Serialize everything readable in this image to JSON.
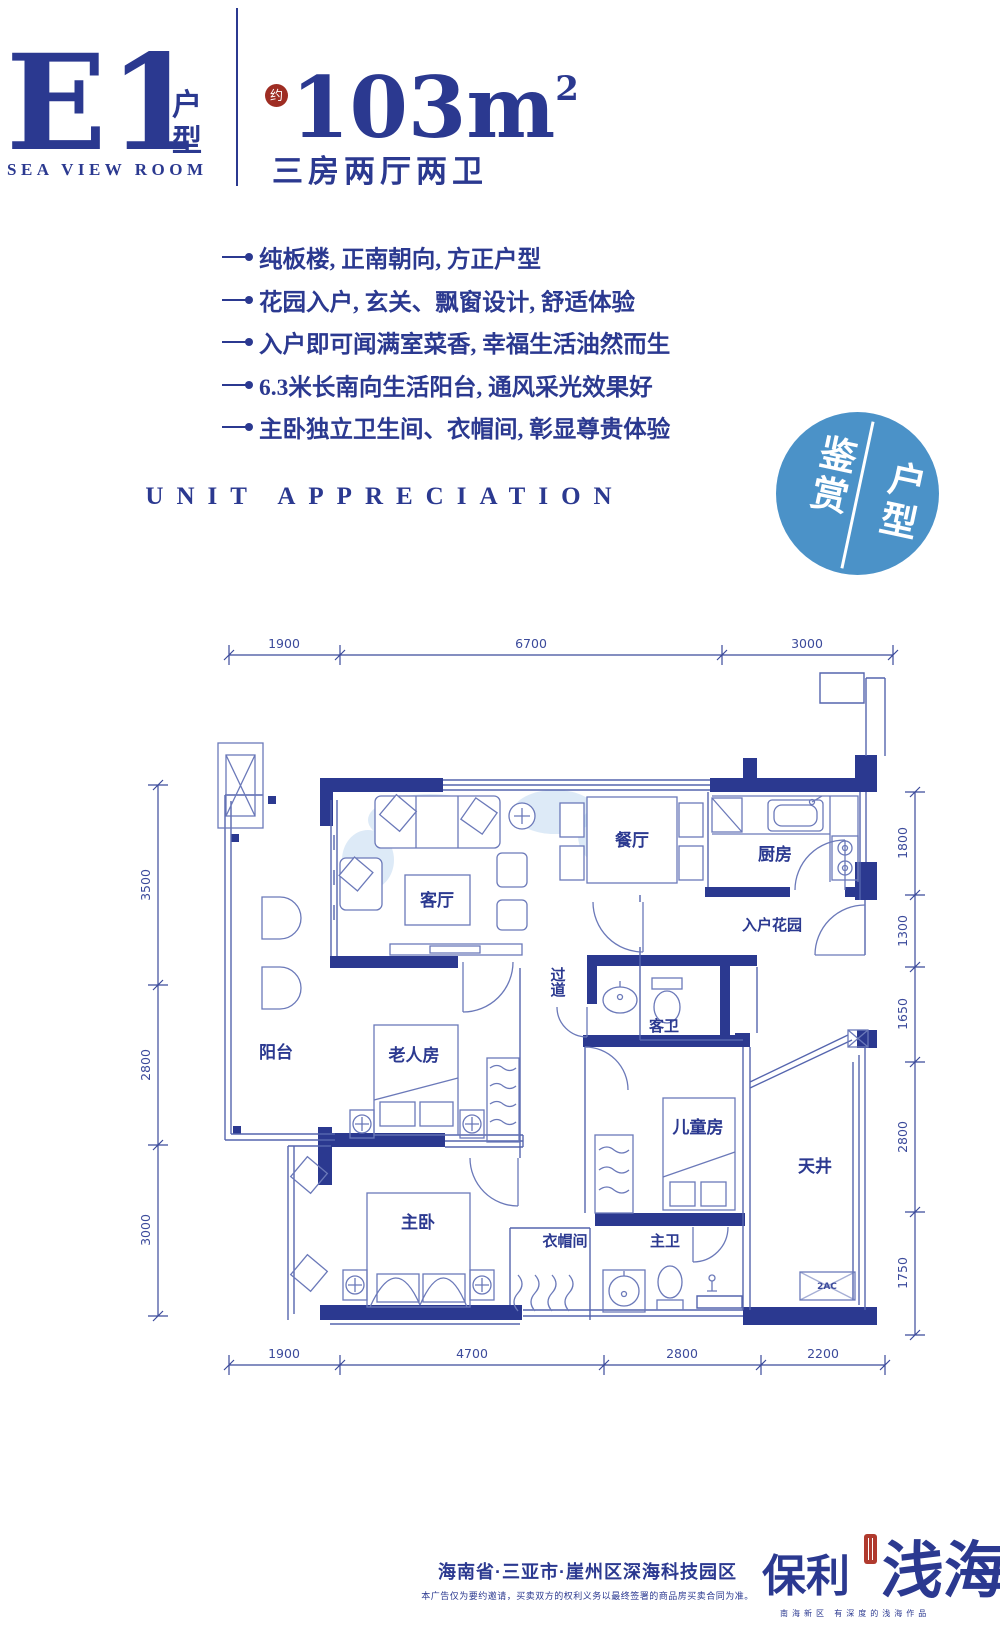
{
  "header": {
    "unit_code": "E1",
    "unit_type_label": "户型",
    "subtitle_en": "SEA VIEW ROOM",
    "approx_label": "约",
    "area_value": "103m",
    "area_sup": "2",
    "layout_label": "三房两厅两卫"
  },
  "features": [
    "纯板楼, 正南朝向, 方正户型",
    "花园入户, 玄关、飘窗设计, 舒适体验",
    "入户即可闻满室菜香, 幸福生活油然而生",
    "6.3米长南向生活阳台, 通风采光效果好",
    "主卧独立卫生间、衣帽间, 彰显尊贵体验"
  ],
  "section_title_en": "UNIT APPRECIATION",
  "badge": {
    "left": "鉴赏",
    "right": "户型"
  },
  "floorplan": {
    "rooms": {
      "living": "客厅",
      "dining": "餐厅",
      "kitchen": "厨房",
      "entry_garden": "入户花园",
      "corridor": "过道",
      "guest_bath": "客卫",
      "balcony": "阳台",
      "elder_room": "老人房",
      "kids_room": "儿童房",
      "patio": "天井",
      "master_bedroom": "主卧",
      "cloakroom": "衣帽间",
      "master_bath": "主卫"
    },
    "ac_label": "2AC",
    "dims_top": [
      "1900",
      "6700",
      "3000"
    ],
    "dims_bottom": [
      "1900",
      "4700",
      "2800",
      "2200"
    ],
    "dims_left": [
      "3500",
      "2800",
      "3000"
    ],
    "dims_right": [
      "1800",
      "1300",
      "1650",
      "2800",
      "1750"
    ]
  },
  "footer": {
    "location": "海南省·三亚市·崖州区深海科技园区",
    "disclaimer": "本广告仅为要约邀请，买卖双方的权利义务以最终签署的商品房买卖合同为准。",
    "brand_left": "保利",
    "brand_right": "浅海",
    "brand_tagline": "南海新区 有深度的浅海作品"
  },
  "colors": {
    "navy": "#2b3990",
    "plan_line": "#5565ae",
    "badge_blue": "#4b92c8",
    "seal_red": "#9e2d23"
  }
}
